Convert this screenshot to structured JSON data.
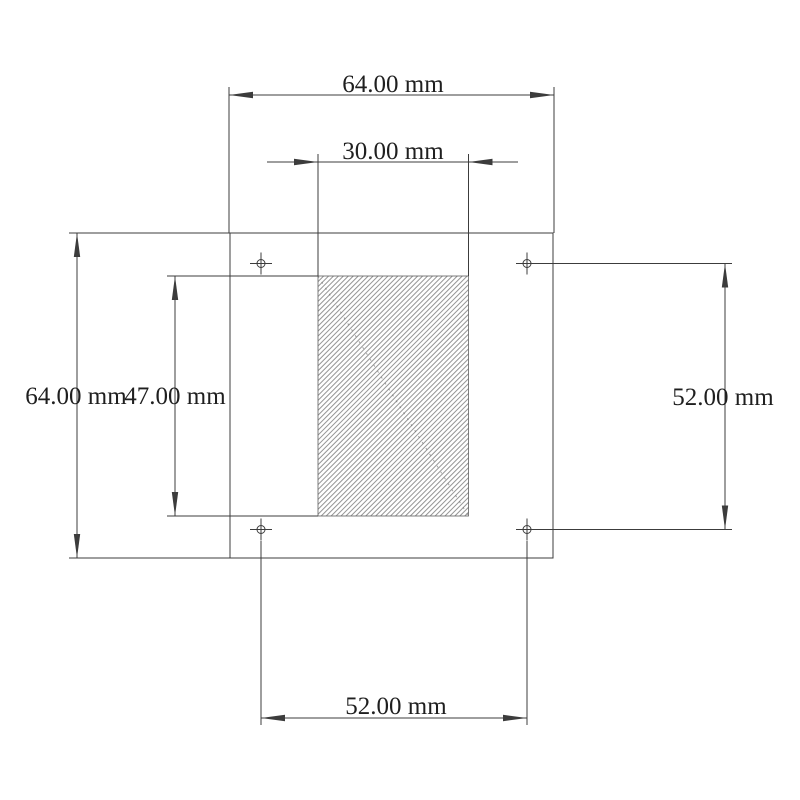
{
  "drawing": {
    "unit": "mm",
    "colors": {
      "background": "#ffffff",
      "line": "#3c3c3c",
      "text": "#1f1f1f",
      "hatch-line": "#949494",
      "hatch-edge": "#5f5f5f"
    },
    "dimensions": {
      "plate_width": {
        "label": "64.00 mm",
        "value": 64.0
      },
      "cutout_width": {
        "label": "30.00 mm",
        "value": 30.0
      },
      "plate_height": {
        "label": "64.00 mm",
        "value": 64.0
      },
      "cutout_height": {
        "label": "47.00 mm",
        "value": 47.0
      },
      "hole_spacing_vertical": {
        "label": "52.00 mm",
        "value": 52.0
      },
      "hole_spacing_horizontal": {
        "label": "52.00 mm",
        "value": 52.0
      }
    },
    "mounting_holes": {
      "count": 4
    }
  }
}
